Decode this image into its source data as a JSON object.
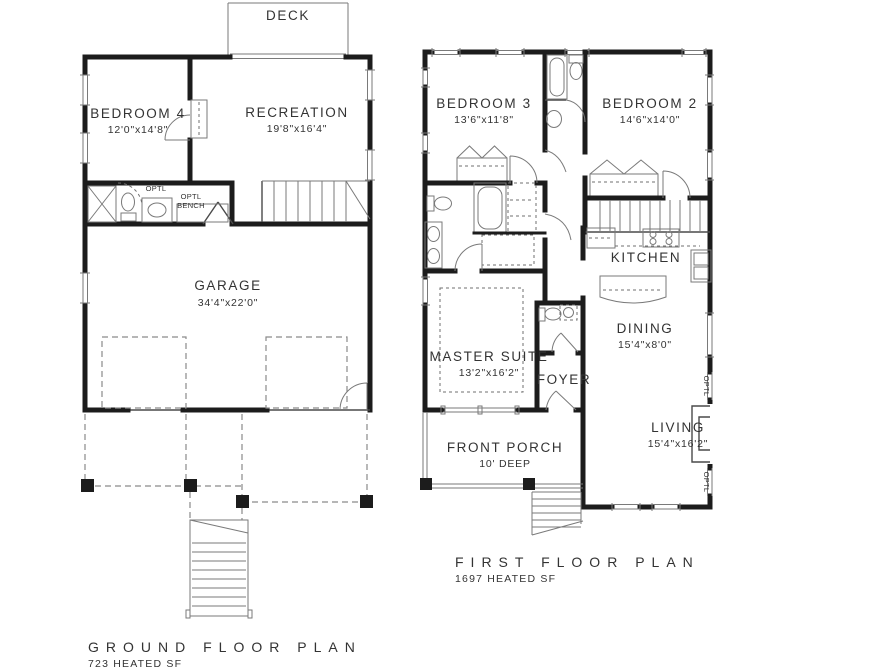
{
  "ground_floor": {
    "deck_label": "DECK",
    "bedroom4_name": "BEDROOM 4",
    "bedroom4_dims": "12'0\"x14'8\"",
    "recreation_name": "RECREATION",
    "recreation_dims": "19'8\"x16'4\"",
    "garage_name": "GARAGE",
    "garage_dims": "34'4\"x22'0\"",
    "opt_door_note": "OPTL",
    "bench_note_line1": "OPTL",
    "bench_note_line2": "BENCH",
    "caption": "GROUND FLOOR PLAN",
    "area": "723 HEATED SF"
  },
  "first_floor": {
    "bedroom3_name": "BEDROOM 3",
    "bedroom3_dims": "13'6\"x11'8\"",
    "bedroom2_name": "BEDROOM 2",
    "bedroom2_dims": "14'6\"x14'0\"",
    "kitchen_name": "KITCHEN",
    "dining_name": "DINING",
    "dining_dims": "15'4\"x8'0\"",
    "master_name": "MASTER SUITE",
    "master_dims": "13'2\"x16'2\"",
    "foyer_name": "FOYER",
    "porch_name": "FRONT PORCH",
    "porch_dims": "10' DEEP",
    "living_name": "LIVING",
    "living_dims": "15'4\"x16'2\"",
    "opt_window_note": "OPTL",
    "caption": "FIRST FLOOR PLAN",
    "area": "1697 HEATED SF"
  },
  "colors": {
    "wall": "#1c1c1c",
    "thin_line": "#7a7a7a",
    "text": "#333333",
    "background": "#ffffff"
  }
}
